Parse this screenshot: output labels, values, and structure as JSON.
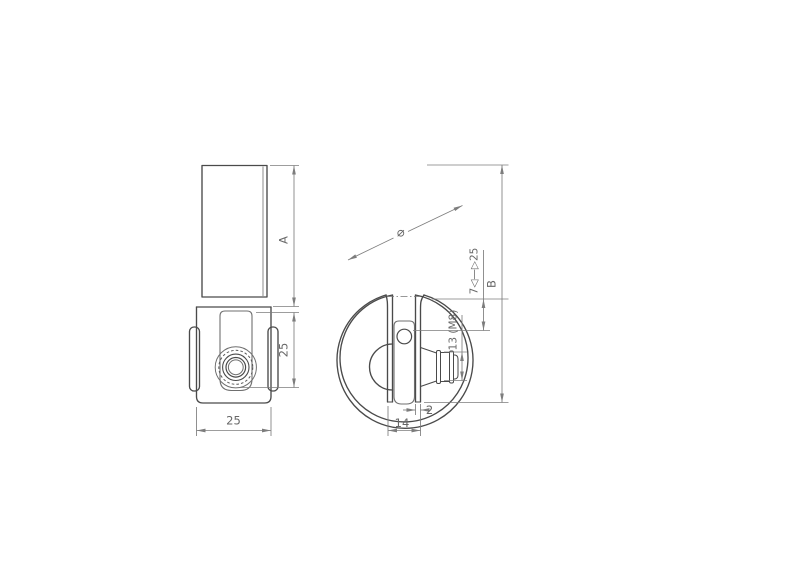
{
  "drawing": {
    "side_view": {
      "length_label": "A",
      "clamp_height_label": "25",
      "width_label": "25"
    },
    "front_view": {
      "diameter_symbol": "⌀",
      "overall_height_label": "B",
      "clamping_range_label": "7◁—▷25",
      "bolt_label": "13 (M8)",
      "thickness_label": "2",
      "strap_width_label": "14"
    },
    "colors": {
      "background": "#ffffff",
      "outline": "#4a4a4a",
      "dimension": "#7d7d7d",
      "text": "#676767"
    }
  }
}
